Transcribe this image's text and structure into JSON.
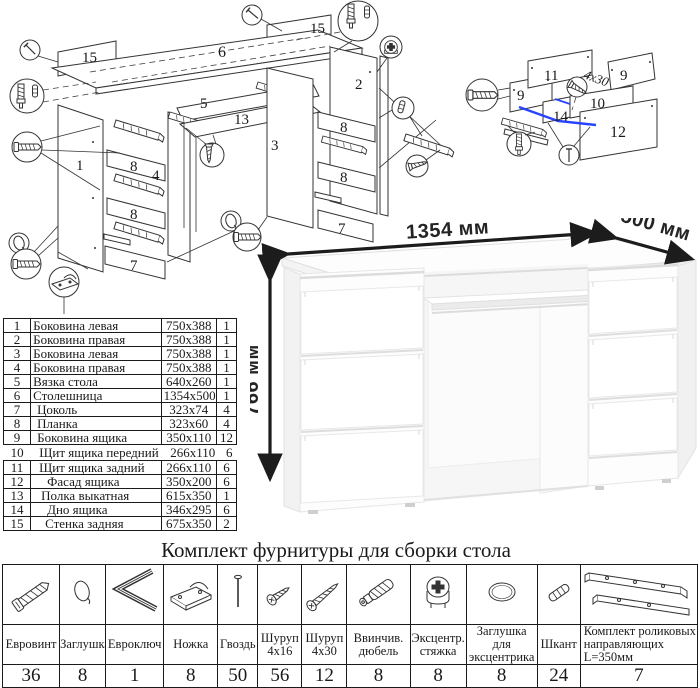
{
  "title": "Комплект фурнитуры для сборки стола",
  "colors": {
    "highlight_blue": "#2743ff",
    "line": "#333333",
    "dimension_text": "#242424"
  },
  "desk": {
    "width_label": "1354 мм",
    "depth_label": "500 мм",
    "height_label": "766 мм"
  },
  "diagram_left": {
    "p1": "1",
    "p2": "2",
    "p3": "3",
    "p4": "4",
    "p5": "5",
    "p6": "6",
    "p7": "7",
    "p8": "8",
    "p13": "13",
    "p15": "15"
  },
  "diagram_right": {
    "p9": "9",
    "p10": "10",
    "p11": "11",
    "p12": "12",
    "p14": "14",
    "screw_note": "4х30"
  },
  "parts": {
    "rows": [
      {
        "n": "1",
        "name": "Боковина левая",
        "size": "750x388",
        "qty": "1"
      },
      {
        "n": "2",
        "name": "Боковина правая",
        "size": "750x388",
        "qty": "1"
      },
      {
        "n": "3",
        "name": "Боковина левая",
        "size": "750x388",
        "qty": "1"
      },
      {
        "n": "4",
        "name": "Боковина правая",
        "size": "750x388",
        "qty": "1"
      },
      {
        "n": "5",
        "name": "Вязка стола",
        "size": "640x260",
        "qty": "1"
      },
      {
        "n": "6",
        "name": "Столешница",
        "size": "1354x500",
        "qty": "1"
      },
      {
        "n": "7",
        "name": "Цоколь",
        "size": "323x74",
        "qty": "4"
      },
      {
        "n": "8",
        "name": "Планка",
        "size": "323x60",
        "qty": "4"
      },
      {
        "n": "9",
        "name": "Боковина ящика",
        "size": "350x110",
        "qty": "12"
      },
      {
        "n": "10",
        "name": "Щит ящика передний",
        "size": "266x110",
        "qty": "6"
      },
      {
        "n": "11",
        "name": "Щит ящика задний",
        "size": "266x110",
        "qty": "6"
      },
      {
        "n": "12",
        "name": "Фасад ящика",
        "size": "350x200",
        "qty": "6"
      },
      {
        "n": "13",
        "name": "Полка выкатная",
        "size": "615x350",
        "qty": "1"
      },
      {
        "n": "14",
        "name": "Дно ящика",
        "size": "346x295",
        "qty": "6"
      },
      {
        "n": "15",
        "name": "Стенка задняя",
        "size": "675x350",
        "qty": "2"
      }
    ]
  },
  "hardware": {
    "items": [
      {
        "label": "Евровинт",
        "qty": "36",
        "icon": "euroscrew-icon"
      },
      {
        "label": "Заглушка",
        "qty": "8",
        "icon": "cap-icon"
      },
      {
        "label": "Евроключ",
        "qty": "1",
        "icon": "hex-key-icon"
      },
      {
        "label": "Ножка",
        "qty": "8",
        "icon": "foot-icon"
      },
      {
        "label": "Гвоздь",
        "qty": "50",
        "icon": "nail-icon"
      },
      {
        "label": "Шуруп 4х16",
        "qty": "56",
        "icon": "screw-short-icon"
      },
      {
        "label": "Шуруп 4х30",
        "qty": "12",
        "icon": "screw-long-icon"
      },
      {
        "label": "Ввинчив. дюбель",
        "qty": "8",
        "icon": "dowel-screw-icon"
      },
      {
        "label": "Эксцентр. стяжка",
        "qty": "8",
        "icon": "cam-lock-icon"
      },
      {
        "label": "Заглушка для эксцентрика",
        "qty": "8",
        "icon": "cam-cap-icon"
      },
      {
        "label": "Шкант",
        "qty": "24",
        "icon": "wood-dowel-icon"
      },
      {
        "label": "Комплект роликовых направляющих L=350мм",
        "qty": "7",
        "icon": "drawer-slide-icon"
      }
    ]
  }
}
